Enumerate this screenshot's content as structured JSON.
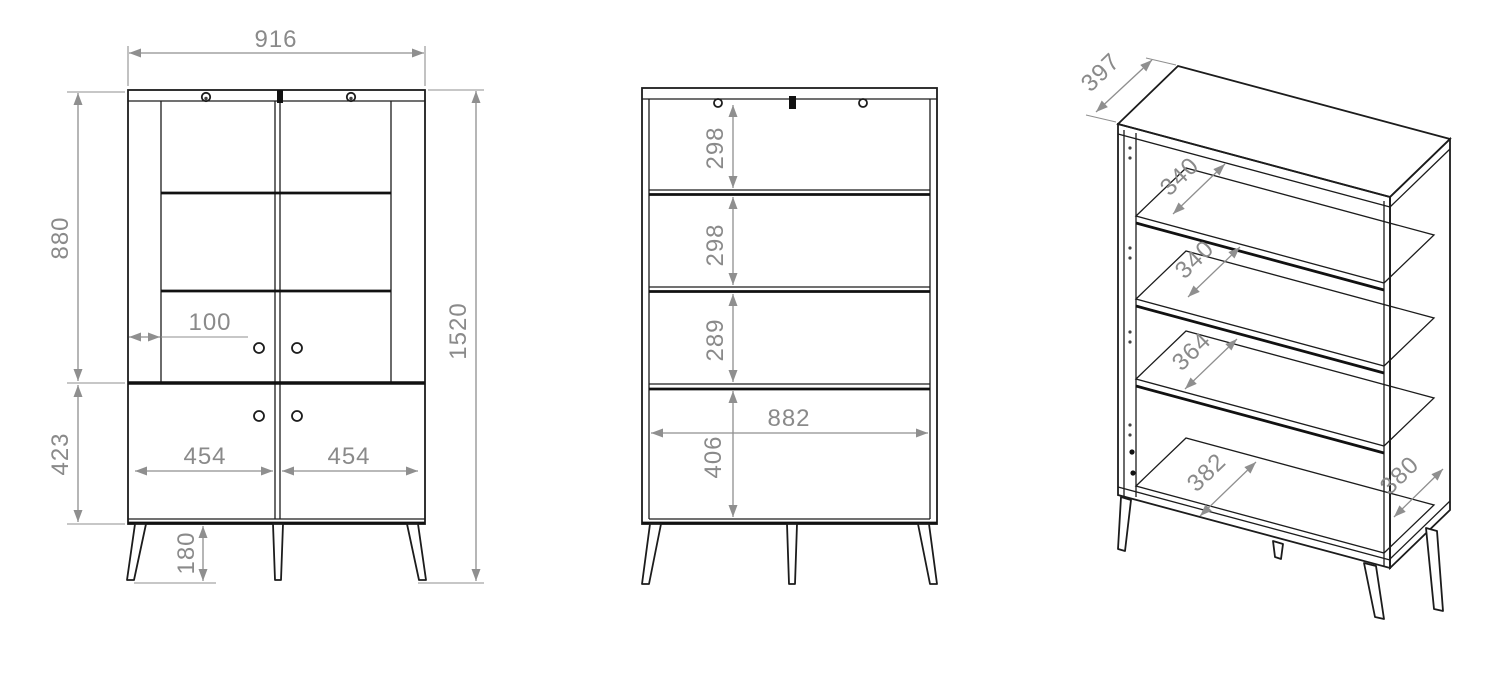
{
  "drawing": {
    "front": {
      "width": "916",
      "upper_height": "880",
      "lower_height": "423",
      "total_height": "1520",
      "door_stile": "100",
      "door_left_width": "454",
      "door_right_width": "454",
      "leg_height": "180"
    },
    "interior": {
      "gap_top": "298",
      "gap_middle": "298",
      "gap_lower": "289",
      "gap_bottom": "406",
      "inner_width": "882"
    },
    "iso": {
      "top_depth": "397",
      "shelf1_depth": "340",
      "shelf2_depth": "340",
      "shelf3_depth": "364",
      "bottom_depth": "382",
      "side_depth": "380"
    }
  },
  "colors": {
    "line": "#1c1c1c",
    "dimension": "#8a8a8a",
    "background": "#ffffff"
  }
}
